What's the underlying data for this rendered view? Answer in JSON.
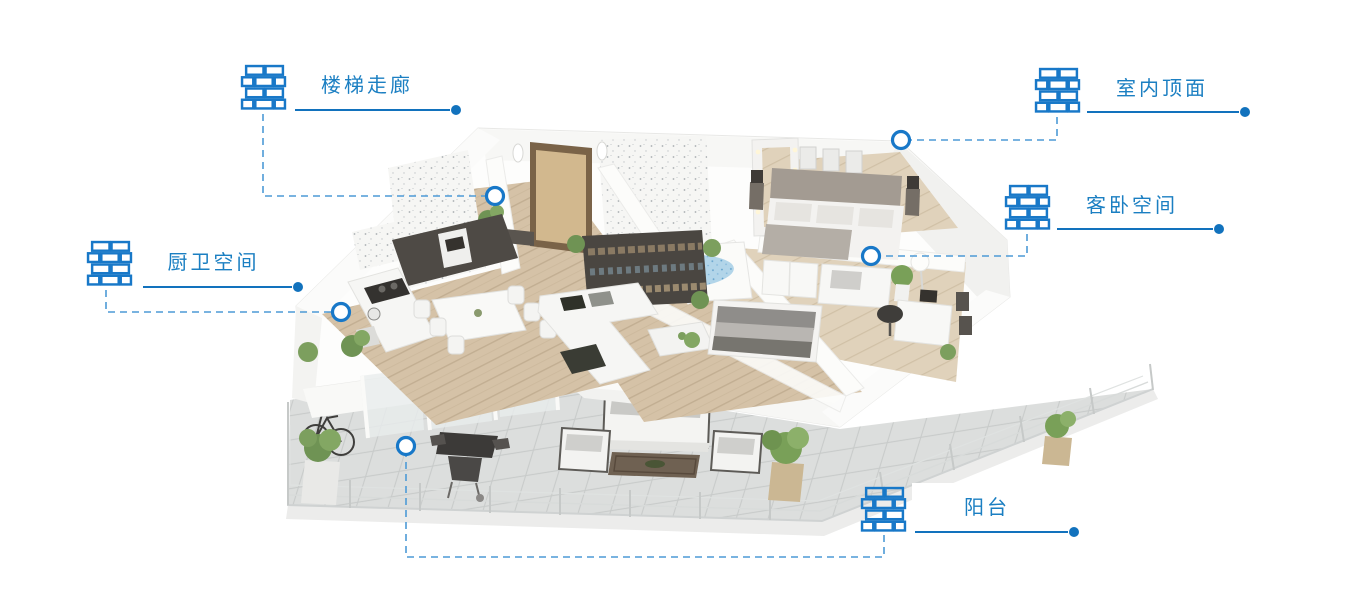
{
  "diagram_title": "apartment-3d-floorplan-hotspots",
  "colors": {
    "accent_line": "#1272bd",
    "accent_icon": "#1878c8",
    "accent_text": "#1b7fc2",
    "dashed_connector": "#4d9ad6",
    "marker_ring": "#1878c8",
    "marker_fill": "#ffffff"
  },
  "callouts": [
    {
      "id": "stair-corridor",
      "label": "楼梯走廊",
      "icon": "brick-wall-icon"
    },
    {
      "id": "interior-ceiling",
      "label": "室内顶面",
      "icon": "brick-wall-icon"
    },
    {
      "id": "guest-bedroom",
      "label": "客卧空间",
      "icon": "brick-wall-icon"
    },
    {
      "id": "kitchen-bathroom",
      "label": "厨卫空间",
      "icon": "brick-wall-icon"
    },
    {
      "id": "balcony",
      "label": "阳台",
      "icon": "brick-wall-icon"
    }
  ]
}
